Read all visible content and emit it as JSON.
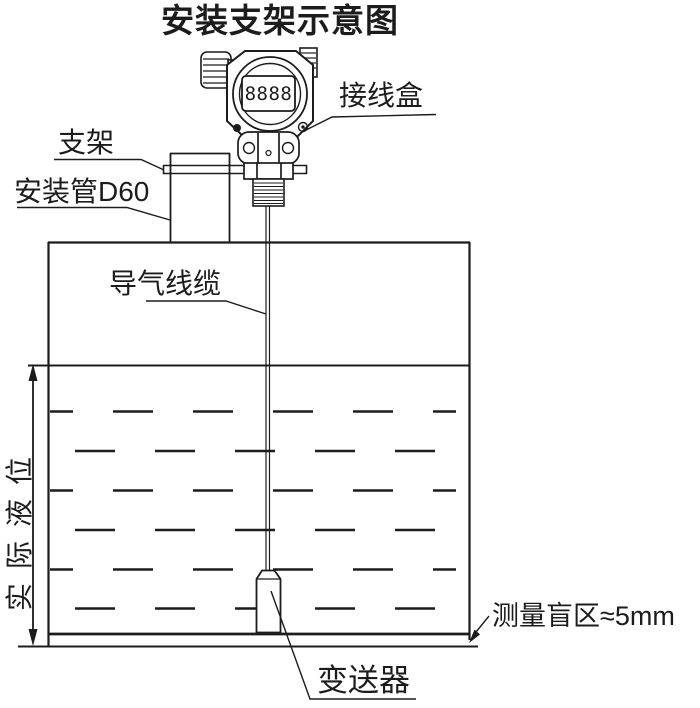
{
  "title": "安装支架示意图",
  "labels": {
    "junction_box": "接线盒",
    "bracket": "支架",
    "mounting_pipe": "安装管D60",
    "air_cable": "导气线缆",
    "actual_level": "实际液位",
    "blind_zone": "测量盲区≈5mm",
    "transmitter": "变送器"
  },
  "display_value": "8888",
  "colors": {
    "line": "#1c1c1c",
    "background": "#ffffff"
  }
}
